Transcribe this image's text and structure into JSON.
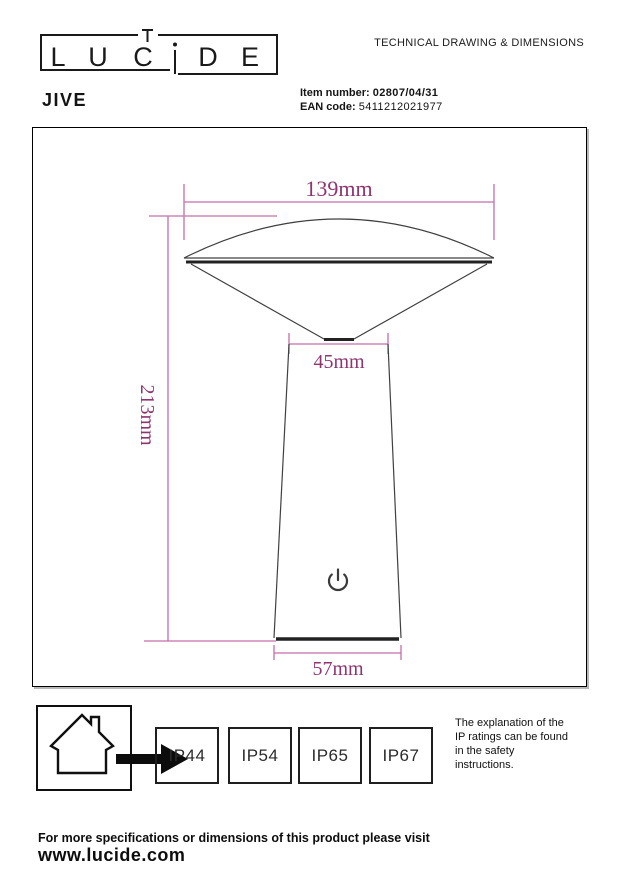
{
  "header": {
    "logo_letters": [
      "L",
      "U",
      "C",
      "i",
      "D",
      "E"
    ],
    "doc_title": "TECHNICAL DRAWING & DIMENSIONS",
    "product_name": "JIVE",
    "item_number_label": "Item number:",
    "item_number_value": "02807/04/31",
    "ean_label": "EAN code:",
    "ean_value": "5411212021977"
  },
  "drawing": {
    "dimensions": {
      "shade_width": "139mm",
      "neck_width": "45mm",
      "total_height": "213mm",
      "base_width": "57mm"
    },
    "colors": {
      "dimension_line": "#c36fa9",
      "dimension_text": "#8e3570",
      "outline": "#404040",
      "thick_edge": "#222222"
    }
  },
  "footer": {
    "ip_ratings": [
      "IP44",
      "IP54",
      "IP65",
      "IP67"
    ],
    "explanation": "The explanation of the\nIP ratings can be found\nin the safety\ninstructions.",
    "visit_line": "For more specifications or dimensions of this product please visit",
    "website": "www.lucide.com"
  }
}
